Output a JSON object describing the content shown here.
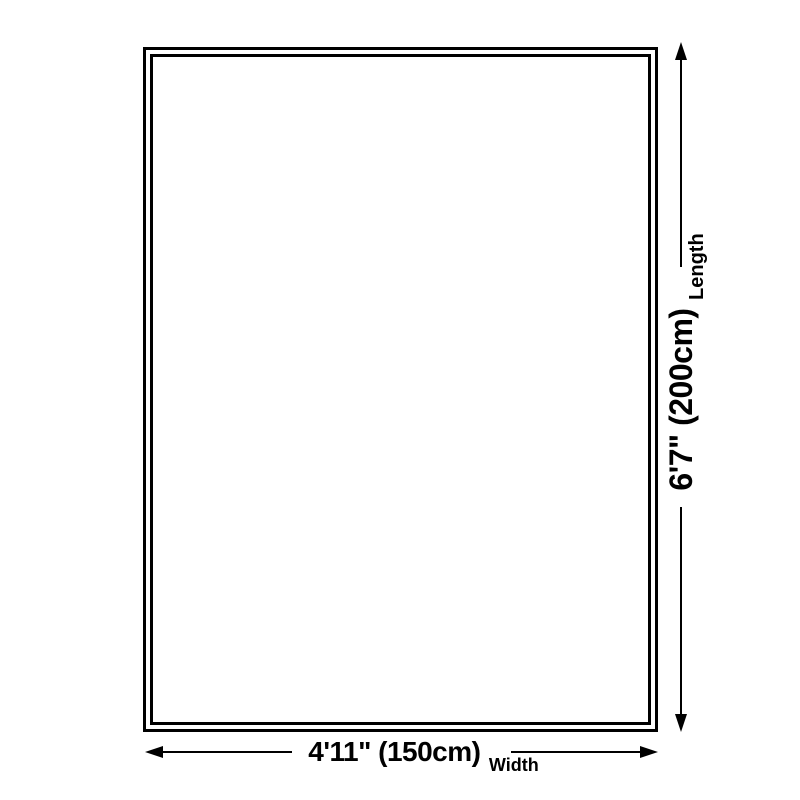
{
  "diagram": {
    "kind": "product-size-diagram",
    "length_dimension": {
      "value": "6'7\" (200cm)",
      "axis_label": "Length"
    },
    "width_dimension": {
      "value": "4'11\" (150cm)",
      "axis_label": "Width"
    },
    "colors": {
      "ink": "#000000",
      "background": "#ffffff"
    }
  }
}
